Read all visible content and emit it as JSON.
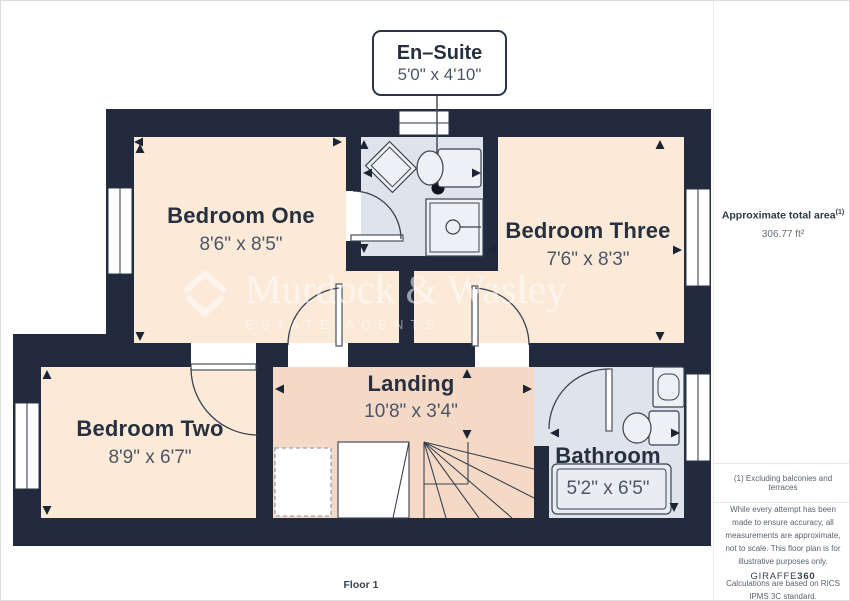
{
  "plan": {
    "floor_label": "Floor 1",
    "callout": {
      "title": "En–Suite",
      "dims": "5'0\" x 4'10\""
    },
    "rooms": [
      {
        "id": "bedroom-one",
        "name": "Bedroom One",
        "dims": "8'6\" x 8'5\"",
        "x": 240,
        "name_y": 204,
        "dims_y": 234
      },
      {
        "id": "bedroom-three",
        "name": "Bedroom Three",
        "dims": "7'6\" x 8'3\"",
        "x": 587,
        "name_y": 219,
        "dims_y": 249
      },
      {
        "id": "bedroom-two",
        "name": "Bedroom Two",
        "dims": "8'9\" x 6'7\"",
        "x": 149,
        "name_y": 417,
        "dims_y": 447
      },
      {
        "id": "landing",
        "name": "Landing",
        "dims": "10'8\" x 3'4\"",
        "x": 410,
        "name_y": 372,
        "dims_y": 401
      },
      {
        "id": "bathroom",
        "name": "Bathroom",
        "dims": "5'2\" x 6'5\"",
        "x": 607,
        "name_y": 444,
        "dims_y": 478
      }
    ],
    "watermark": {
      "line1": "Murdock & Wasley",
      "line2": "ESTATE AGENTS"
    }
  },
  "sidebar": {
    "area_label": "Approximate total area",
    "area_sup": "(1)",
    "area_value": "306.77 ft²",
    "footnote": "(1) Excluding balconies and terraces",
    "disclaimer": "While every attempt has been made to ensure accuracy, all measurements are approximate, not to scale. This floor plan is for illustrative purposes only.",
    "standard": "Calculations are based on RICS IPMS 3C standard.",
    "brand": "GIRAFFE",
    "brand_suffix": "360"
  },
  "colors": {
    "wall": "#212b3d",
    "bedroom_floor": "#fcead8",
    "landing_floor": "#f4d9c6",
    "bath_floor": "#dee3ec",
    "fixture_fill": "#edf0f5",
    "outline": "#3a424f",
    "text_dark": "#27303f",
    "text_dim": "#4d5565"
  }
}
